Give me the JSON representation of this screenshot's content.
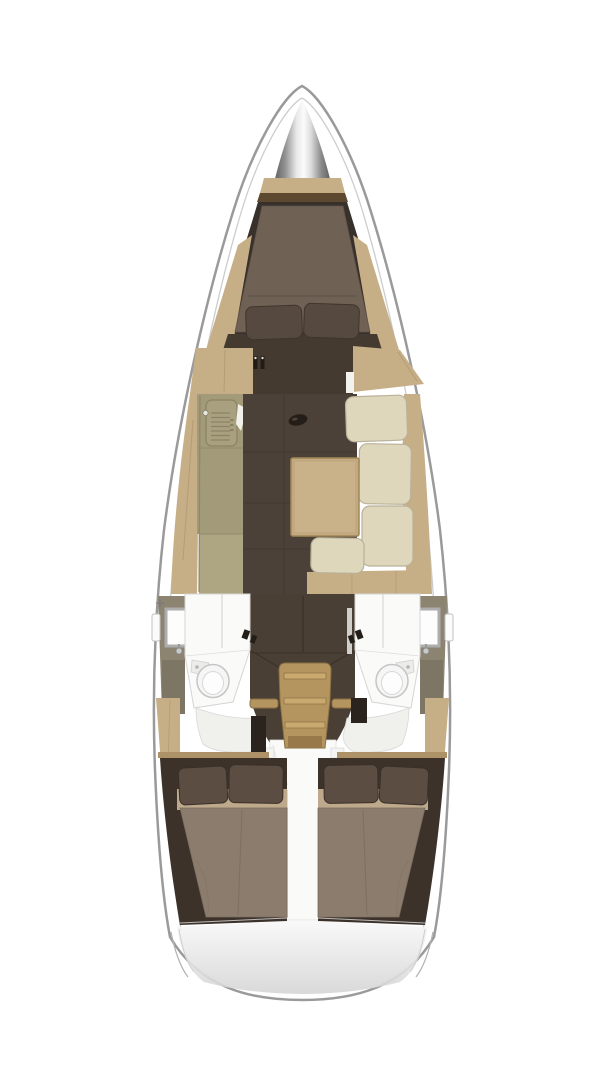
{
  "title": "Sailing yacht interior layout - overhead floor plan, bow at top",
  "colors": {
    "background": "#ffffff",
    "hull_fill": "#ffffff",
    "hull_outline": "#9a9a9a",
    "deck_line": "#cccccc",
    "wood_light": "#c6ae87",
    "wood_mid": "#ad9167",
    "wood_grain": "#b69c74",
    "wood_dark_line": "#8a7044",
    "shelf_dark": "#5c4930",
    "cabin_wall_dark": "#38302a",
    "floor_brown": "#4c4138",
    "floor_seam": "#433931",
    "vberth_mattress": "#6f6154",
    "pillow_dark": "#564940",
    "dresser_dark": "#453a30",
    "galley_counter": "#a39a79",
    "galley_counter_light": "#aea582",
    "stove_line": "#8b8263",
    "cream_cushion": "#ded7bc",
    "cushion_stroke": "#b9b199",
    "table_tan": "#c2a981",
    "table_top": "#c9b189",
    "table_edge": "#a18756",
    "head_wall_olive": "#8c8371",
    "head_wall_olive_dark": "#7e7664",
    "head_center_dark": "#4a3f34",
    "shower_white": "#fafaf8",
    "porcelain": "#f6f6f6",
    "fixture_gray": "#adadad",
    "stairs_tan": "#b5955f",
    "stairs_ridge": "#caa96e",
    "stairs_side": "#a9874f",
    "stairs_shadow": "#97794a",
    "aft_mattress": "#8c7c6d",
    "aft_band": "#bfa98c",
    "aft_pillow": "#5b4d42",
    "aft_wall": "#3c322a",
    "cockpit_white": "#fafaf9",
    "chrome_dark": "#5a5a5a",
    "chrome_light": "#fbfbfb",
    "transom_shade": "#d5d5d5"
  },
  "boat": {
    "view": "top-down, bow at top",
    "areas": [
      {
        "id": "bow-anchor-locker",
        "label": "Bow anchor locker"
      },
      {
        "id": "forward-cabin",
        "label": "Forward V-berth double cabin",
        "features": [
          "tapered double berth",
          "2 pillows",
          "wood side shelves",
          "foot dresser"
        ]
      },
      {
        "id": "saloon",
        "label": "Main saloon",
        "features": [
          "port galley with stove",
          "dinette table",
          "starboard L-shaped settee with cream cushions",
          "dark cabin sole"
        ]
      },
      {
        "id": "port-head",
        "label": "Port head compartment",
        "features": [
          "shower",
          "toilet",
          "washbasin",
          "hull porthole"
        ]
      },
      {
        "id": "starboard-head",
        "label": "Starboard head compartment",
        "features": [
          "shower",
          "toilet",
          "washbasin",
          "hull porthole"
        ]
      },
      {
        "id": "companionway",
        "label": "Companionway steps with grab rails"
      },
      {
        "id": "port-aft-cabin",
        "label": "Port aft double cabin",
        "features": [
          "double berth",
          "2 pillows"
        ]
      },
      {
        "id": "starboard-aft-cabin",
        "label": "Starboard aft double cabin",
        "features": [
          "double berth",
          "2 pillows"
        ]
      },
      {
        "id": "cockpit-sole",
        "label": "Cockpit sole strip between aft cabins"
      },
      {
        "id": "transom",
        "label": "Stern transom"
      }
    ]
  }
}
